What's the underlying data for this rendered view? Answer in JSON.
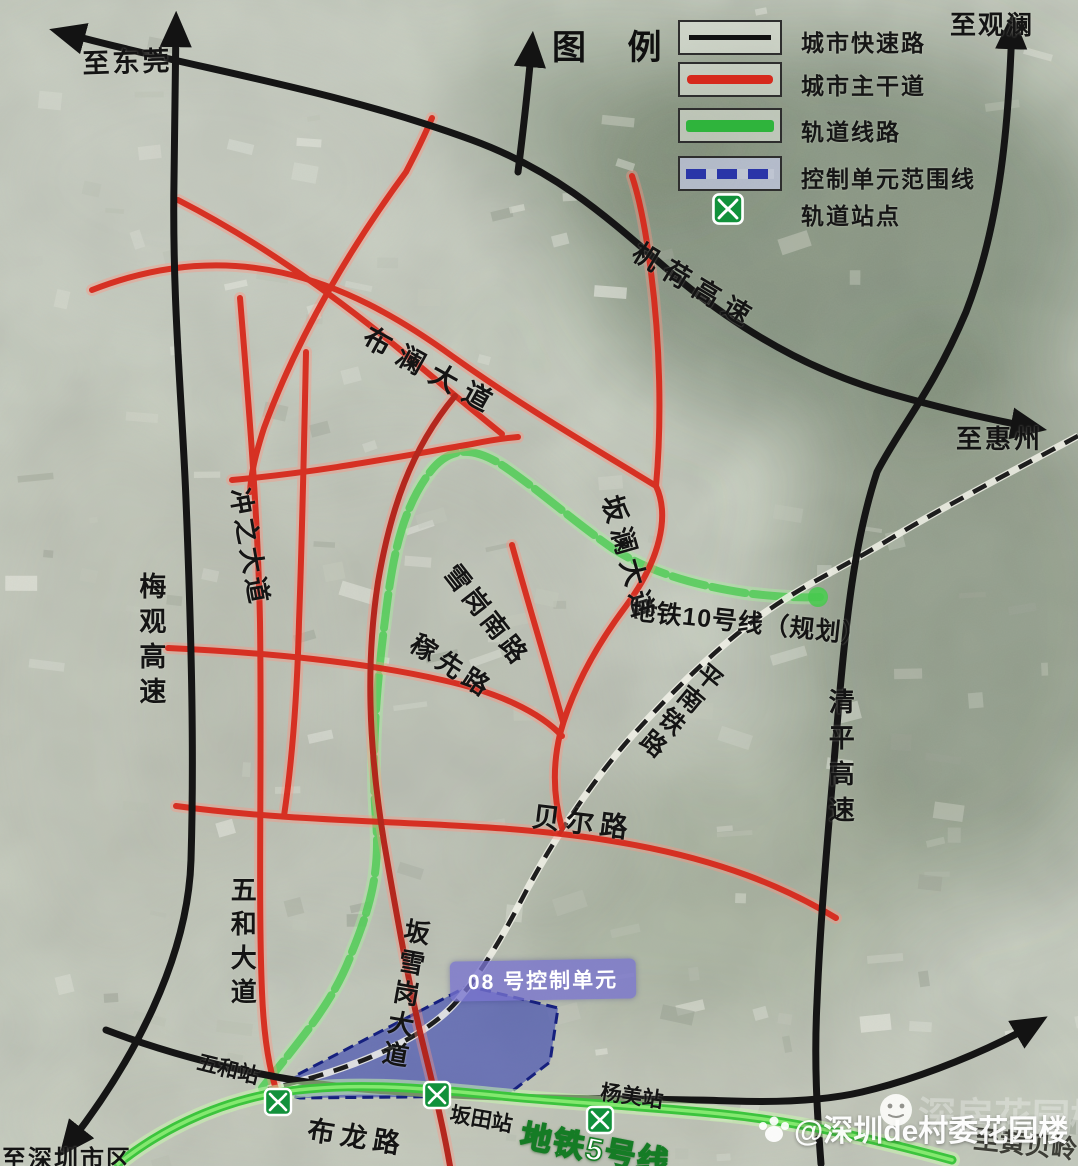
{
  "legend": {
    "title": "图 例",
    "items": [
      {
        "name": "expressway",
        "label": "城市快速路",
        "color": "#161616",
        "style": "solid"
      },
      {
        "name": "arterial",
        "label": "城市主干道",
        "color": "#d6291c",
        "style": "solid"
      },
      {
        "name": "rail",
        "label": "轨道线路",
        "color": "#2fb43c",
        "style": "solid"
      },
      {
        "name": "control-boundary",
        "label": "控制单元范围线",
        "color": "#2a35a8",
        "style": "dashed"
      },
      {
        "name": "station",
        "label": "轨道站点",
        "color": "#12913b",
        "style": "icon"
      }
    ]
  },
  "destinations": {
    "dongguan": "至东莞",
    "guanlan": "至观澜",
    "huizhou": "至惠州",
    "shenzhen_downtown": "至深圳市区",
    "huangbeiling": "至黄贝岭"
  },
  "roads": {
    "jihe_expressway": "机荷高速",
    "meiguan_expressway": "梅观高速",
    "qingping_expressway": "清平高速",
    "bulan_avenue": "布澜大道",
    "banlan_avenue": "坂澜大道",
    "chongzhi_avenue": "冲之大道",
    "wuhe_avenue": "五和大道",
    "banxuegang_avenue": "坂雪岗大道",
    "xuegang_south_road": "雪岗南路",
    "jiaxian_road": "稼先路",
    "beier_road": "贝尔路",
    "bulong_road": "布龙路",
    "pingnan_railway": "平南铁路"
  },
  "metro": {
    "line10_label": "地铁10号线（规划）",
    "line5_label": "地铁5号线"
  },
  "stations": {
    "wuhe": "五和站",
    "bantian": "坂田站",
    "yangmei": "杨美站"
  },
  "control_unit": {
    "label": "08 号控制单元"
  },
  "watermark": {
    "handle": "@深圳de村委花园楼",
    "faint": "深房花园楼"
  },
  "colors": {
    "expressway": "#161616",
    "arterial": "#d6291c",
    "rail_line5": "#3cc43d",
    "rail_line10": "#4ccb52",
    "control_fill": "#3440b0",
    "station_green": "#12913b"
  }
}
